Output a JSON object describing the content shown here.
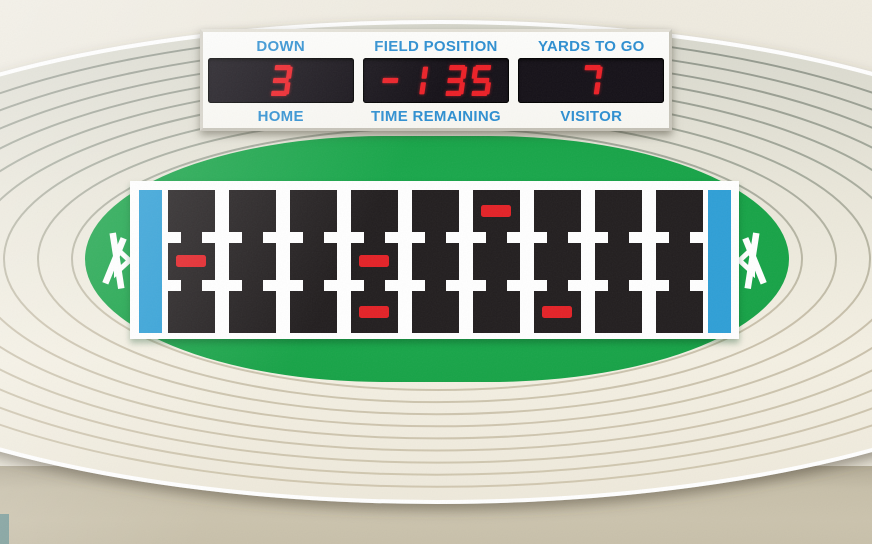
{
  "scoreboard": {
    "fields": [
      {
        "top_label": "DOWN",
        "value": "3",
        "bottom_label": "HOME"
      },
      {
        "top_label": "FIELD POSITION",
        "value": "-1 35",
        "bottom_label": "TIME REMAINING"
      },
      {
        "top_label": "YARDS TO GO",
        "value": "7",
        "bottom_label": "VISITOR"
      }
    ],
    "label_color": "#2E8FD1",
    "led_color": "#EC2027",
    "led_bg": "#151118"
  },
  "field": {
    "columns": 9,
    "rows": [
      "top",
      "middle",
      "bottom"
    ],
    "players": [
      {
        "col": 1,
        "row": "middle"
      },
      {
        "col": 4,
        "row": "middle"
      },
      {
        "col": 4,
        "row": "bottom"
      },
      {
        "col": 6,
        "row": "top"
      },
      {
        "col": 7,
        "row": "bottom"
      }
    ],
    "player_color": "#E32227",
    "endzone_color": "#2F9FD6",
    "grid_color": "#221E1F",
    "turf_color": "#17A347"
  }
}
